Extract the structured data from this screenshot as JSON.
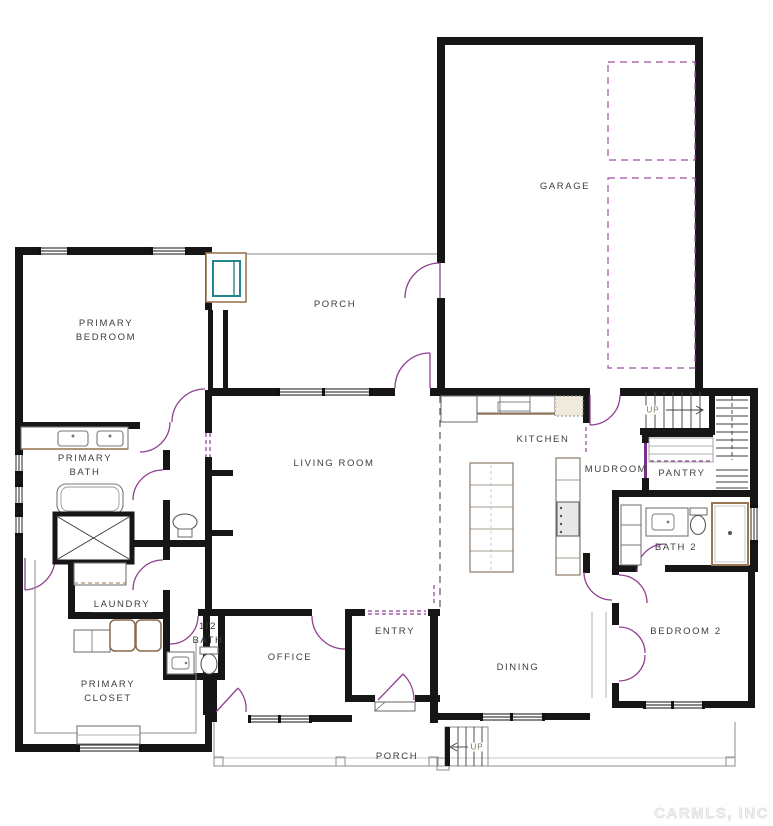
{
  "rooms": {
    "garage": "GARAGE",
    "back_porch": "PORCH",
    "primary_bedroom": "PRIMARY\nBEDROOM",
    "primary_bath": "PRIMARY\nBATH",
    "living_room": "LIVING ROOM",
    "kitchen": "KITCHEN",
    "mudroom": "MUDROOM",
    "pantry": "PANTRY",
    "bath_2": "BATH 2",
    "laundry": "LAUNDRY",
    "half_bath": "1/2\nBATH",
    "office": "OFFICE",
    "entry": "ENTRY",
    "dining": "DINING",
    "bedroom_2": "BEDROOM 2",
    "primary_closet": "PRIMARY\nCLOSET",
    "front_porch": "PORCH"
  },
  "stairs": {
    "interior_up": "UP",
    "exterior_up": "UP"
  },
  "watermark": "CARMLS, INC"
}
